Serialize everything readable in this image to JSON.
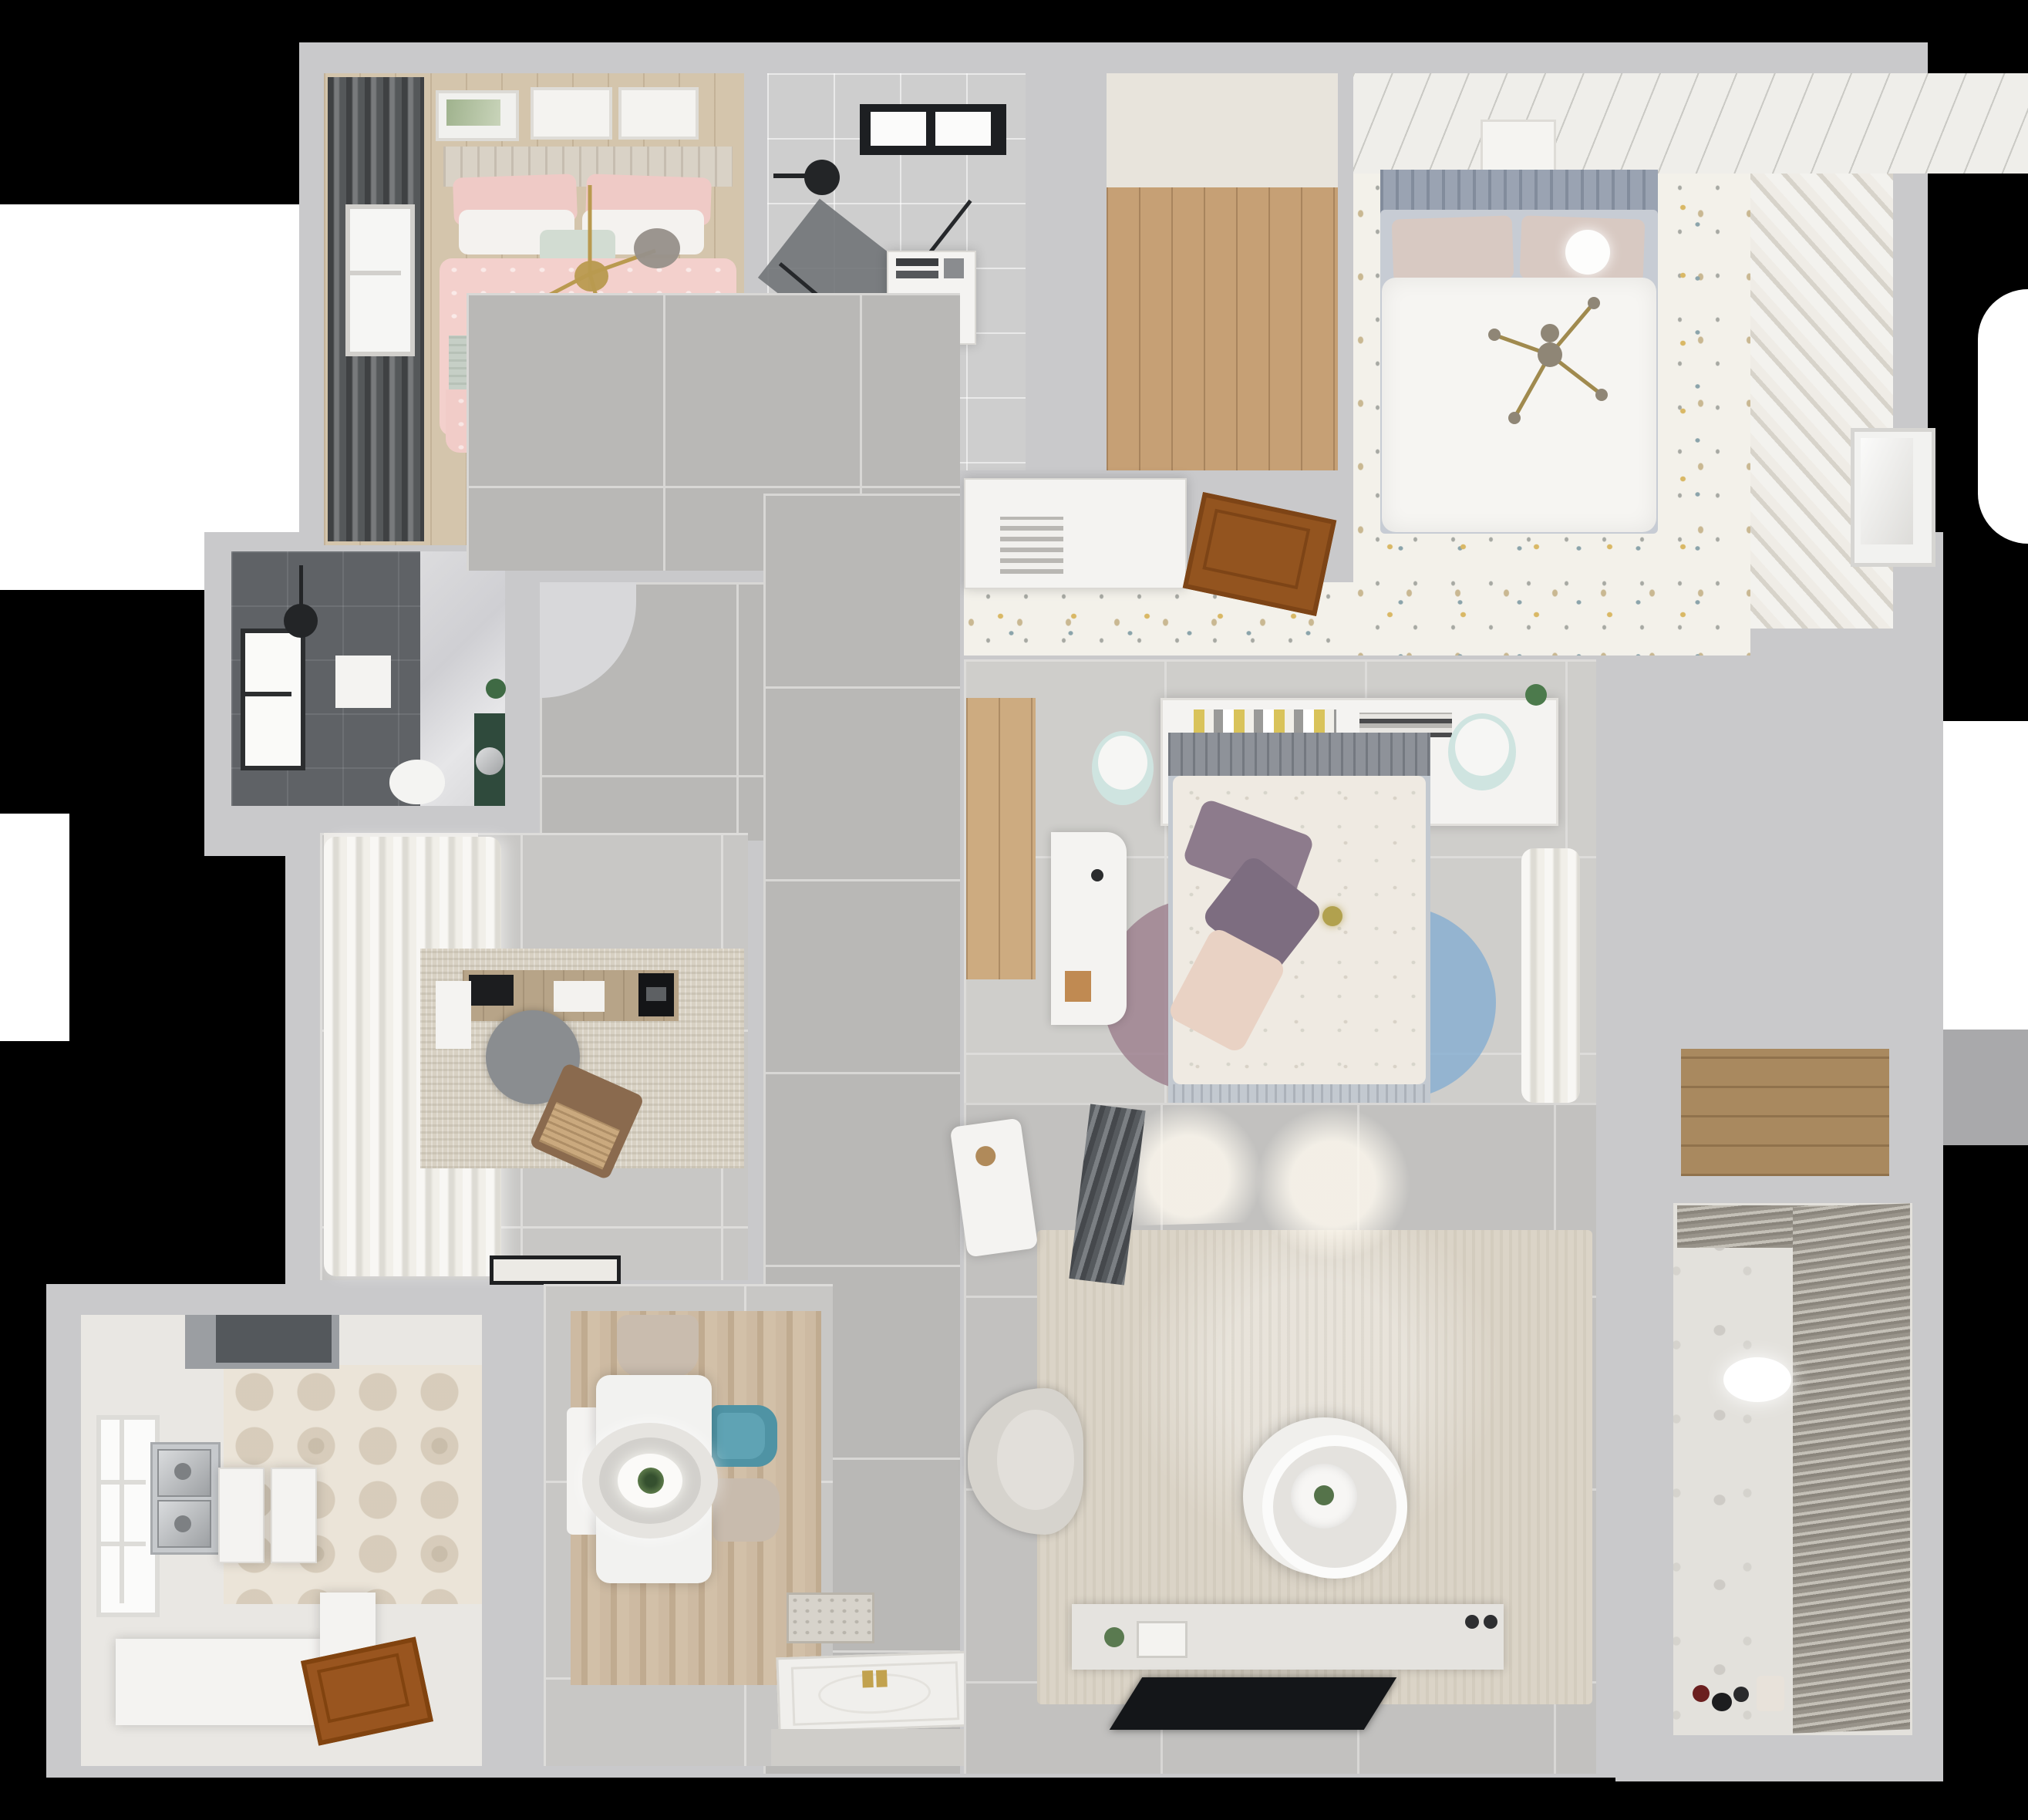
{
  "scene": {
    "type": "3d-floor-plan-top-down-render",
    "background_color": "#000000",
    "wall_color": "#c9c9cb",
    "palette": {
      "corridor_tile": "#b9b8b6",
      "room_tile": "#c8c7c5",
      "wood_floor": "#d4c5ac",
      "oak_nook": "#c6a075",
      "confetti_floor": "#f3f1ea",
      "hex_tile": "#ebe4d8",
      "balcony_tile": "#e3e1dc",
      "pink_duvet": "#f3d0cc",
      "sage_throw": "#c6cfc6",
      "teal_chair": "#4f93a4",
      "purple_pillow": "#8d7b8c",
      "sofa_beige": "#d2c6b5",
      "gold_accent": "#b99a4f",
      "door_wood": "#93541f",
      "shower_dark": "#5f6266",
      "vanity_green": "#2f4a3c"
    },
    "rooms": [
      {
        "name": "bedroom-pink",
        "floor": "light-wood-planks",
        "furniture": [
          "double-bed",
          "pink-patterned-duvet",
          "sage-throw",
          "white-pillows",
          "gold-branch-chandelier",
          "wall-art-frames",
          "dark-curtains",
          "window",
          "dresser"
        ]
      },
      {
        "name": "bathroom-main",
        "floor": "gray-tile",
        "furniture": [
          "skylight-window",
          "black-shower-head",
          "glass-shower-screen",
          "washer-cabinet",
          "toilet"
        ]
      },
      {
        "name": "entry-closet-nook",
        "floor": "oak-planks",
        "furniture": [
          "white-cabinet"
        ]
      },
      {
        "name": "bedroom-master",
        "floor": "confetti-pattern-tile",
        "furniture": [
          "double-bed-white-duvet",
          "blue-gray-headboard",
          "beige-pillows",
          "gold-cross-pendant",
          "ceiling-planks",
          "diagonal-slat-closet",
          "vented-wardrobe",
          "open-wood-door",
          "art-frame"
        ]
      },
      {
        "name": "shower-room",
        "floor": "dark-tile-and-marble",
        "furniture": [
          "window",
          "ceiling-lamp",
          "shower-mat",
          "toilet",
          "green-vanity-with-sink"
        ]
      },
      {
        "name": "hallway",
        "floor": "large-gray-tile",
        "furniture": [
          "curved-wall-corner"
        ]
      },
      {
        "name": "study",
        "floor": "gray-tile",
        "furniture": [
          "white-curtains",
          "textured-rug",
          "wood-desk",
          "monitor",
          "round-gray-chair",
          "brown-lounge-chair",
          "black-doormat",
          "top-cabinet"
        ]
      },
      {
        "name": "kitchen",
        "floor": "hex-pattern-tile",
        "furniture": [
          "range-hood",
          "double-stainless-sink",
          "white-counters",
          "l-shaped-counter",
          "window",
          "wood-entry-door"
        ]
      },
      {
        "name": "dining-room",
        "floor": "wood-look-rug-over-tile",
        "furniture": [
          "white-dining-table",
          "ring-pendant-lamp",
          "plant-centerpiece",
          "beige-chair",
          "teal-chair",
          "beige-chair-2",
          "white-bench",
          "patterned-doormat",
          "front-door"
        ]
      },
      {
        "name": "bedroom-center",
        "floor": "light-tile",
        "furniture": [
          "double-bed-floral-duvet",
          "gray-headboard",
          "purple-pillows",
          "peach-pillow",
          "headboard-shelf-with-books",
          "pouf-left",
          "pouf-right",
          "white-desk",
          "petal-rug",
          "curtain-closet",
          "wood-entry-strip",
          "plant"
        ]
      },
      {
        "name": "living-room",
        "floor": "gray-tile",
        "furniture": [
          "corner-sofa",
          "gray-throw",
          "large-rug",
          "round-two-tier-coffee-table",
          "armchair",
          "white-side-table",
          "tv-console",
          "flat-tv"
        ]
      },
      {
        "name": "balcony-laundry",
        "floor": "patterned-tile",
        "furniture": [
          "venetian-blinds",
          "oval-ceiling-light",
          "wood-storage-niche",
          "toys",
          "white-exterior-door"
        ]
      }
    ]
  }
}
